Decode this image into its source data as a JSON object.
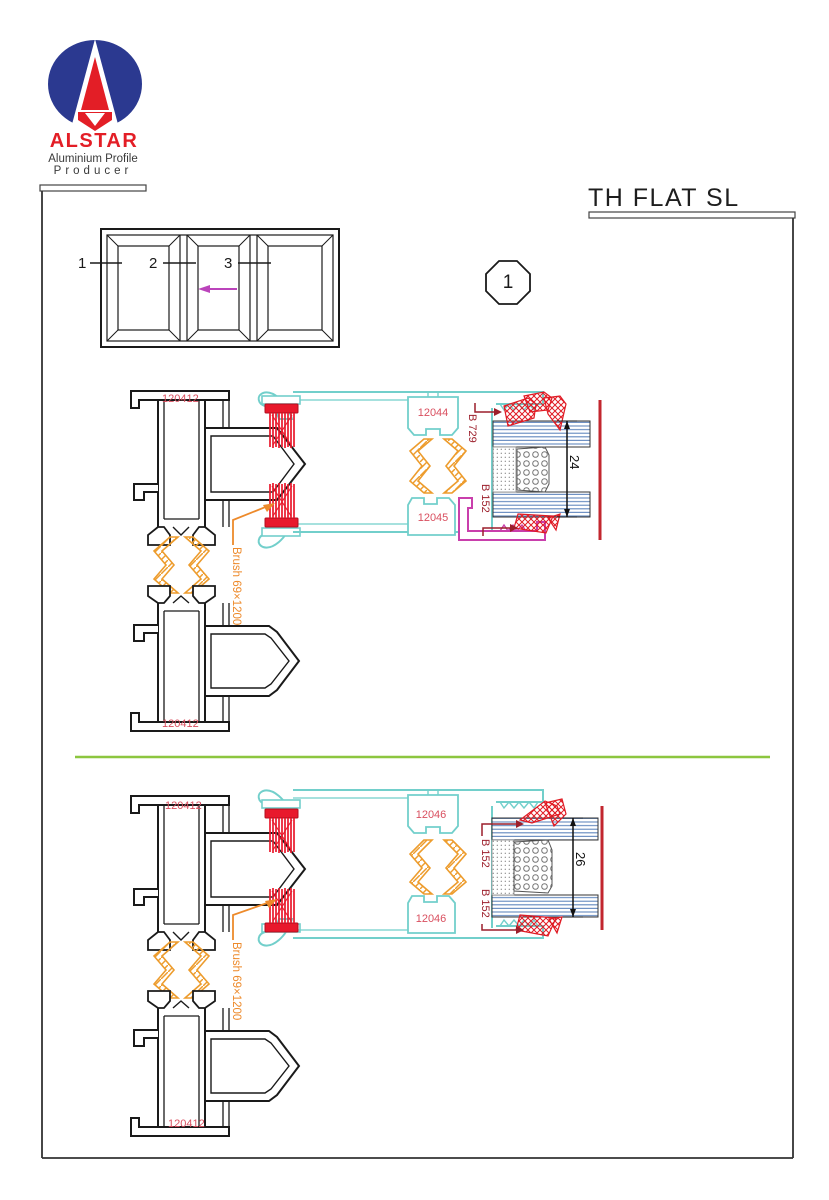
{
  "logo": {
    "brand": "ALSTAR",
    "tagline1": "Aluminium Profile",
    "tagline2": "Producer"
  },
  "title": "TH FLAT SL",
  "detail_marker": "1",
  "elevation": {
    "panel_labels": [
      "1",
      "2",
      "3"
    ]
  },
  "colors": {
    "logo_navy": "#2B3990",
    "logo_red": "#E31E26",
    "profile_black": "#1a1a1a",
    "sash_cyan": "#72CFCB",
    "thermal_break_orange": "#ED9C2D",
    "brush_red": "#E8192C",
    "label_red": "#D94F5F",
    "gasket_label_maroon": "#9C1F2B",
    "bead_magenta": "#C93FAC",
    "divider_green": "#8CC63F",
    "glass_blue": "#6288BE",
    "glass_edge_red": "#C2262E",
    "arrow_magenta": "#BB44BB"
  },
  "details": [
    {
      "frame_label_top": "120412",
      "frame_label_bottom": "120412",
      "sash_label_top": "12044",
      "sash_label_bottom": "12045",
      "gasket_label_top": "B 729",
      "gasket_label_bottom": "B 152",
      "glass_dimension": "24",
      "brush_label": "Brush 69×1200"
    },
    {
      "frame_label_top": "120412",
      "frame_label_bottom": "120412",
      "sash_label_top": "12046",
      "sash_label_bottom": "12046",
      "gasket_label_top": "B 152",
      "gasket_label_bottom": "B 152",
      "glass_dimension": "26",
      "brush_label": "Brush 69×1200"
    }
  ]
}
